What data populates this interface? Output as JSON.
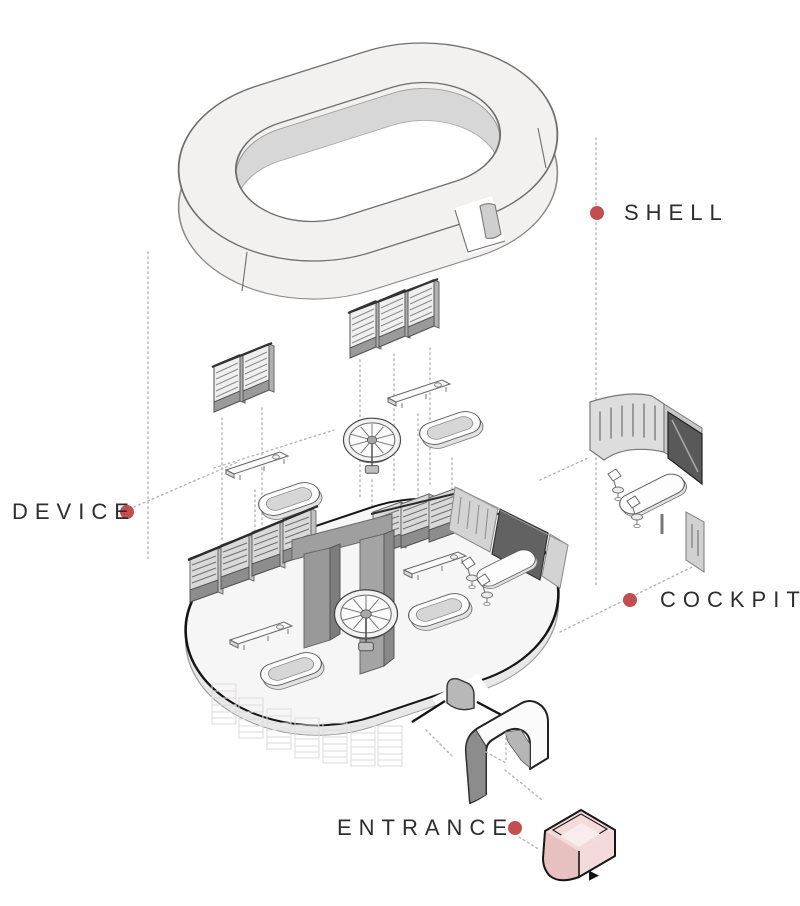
{
  "diagram": {
    "labels": {
      "shell": "SHELL",
      "device": "DEVICE",
      "cockpit": "COCKPIT",
      "entrance": "ENTRANCE"
    },
    "colors": {
      "accent_dot": "#c14f4f",
      "entrance_highlight": "#f3dada",
      "entrance_highlight_side": "#e7c0c0",
      "shell_light": "#f2f1f0",
      "shell_inner": "#d8d7d7",
      "screen_dark": "#626262",
      "outline_black": "#151515"
    },
    "icons": {
      "play_arrow": "▶",
      "leader_dot": "●"
    }
  }
}
